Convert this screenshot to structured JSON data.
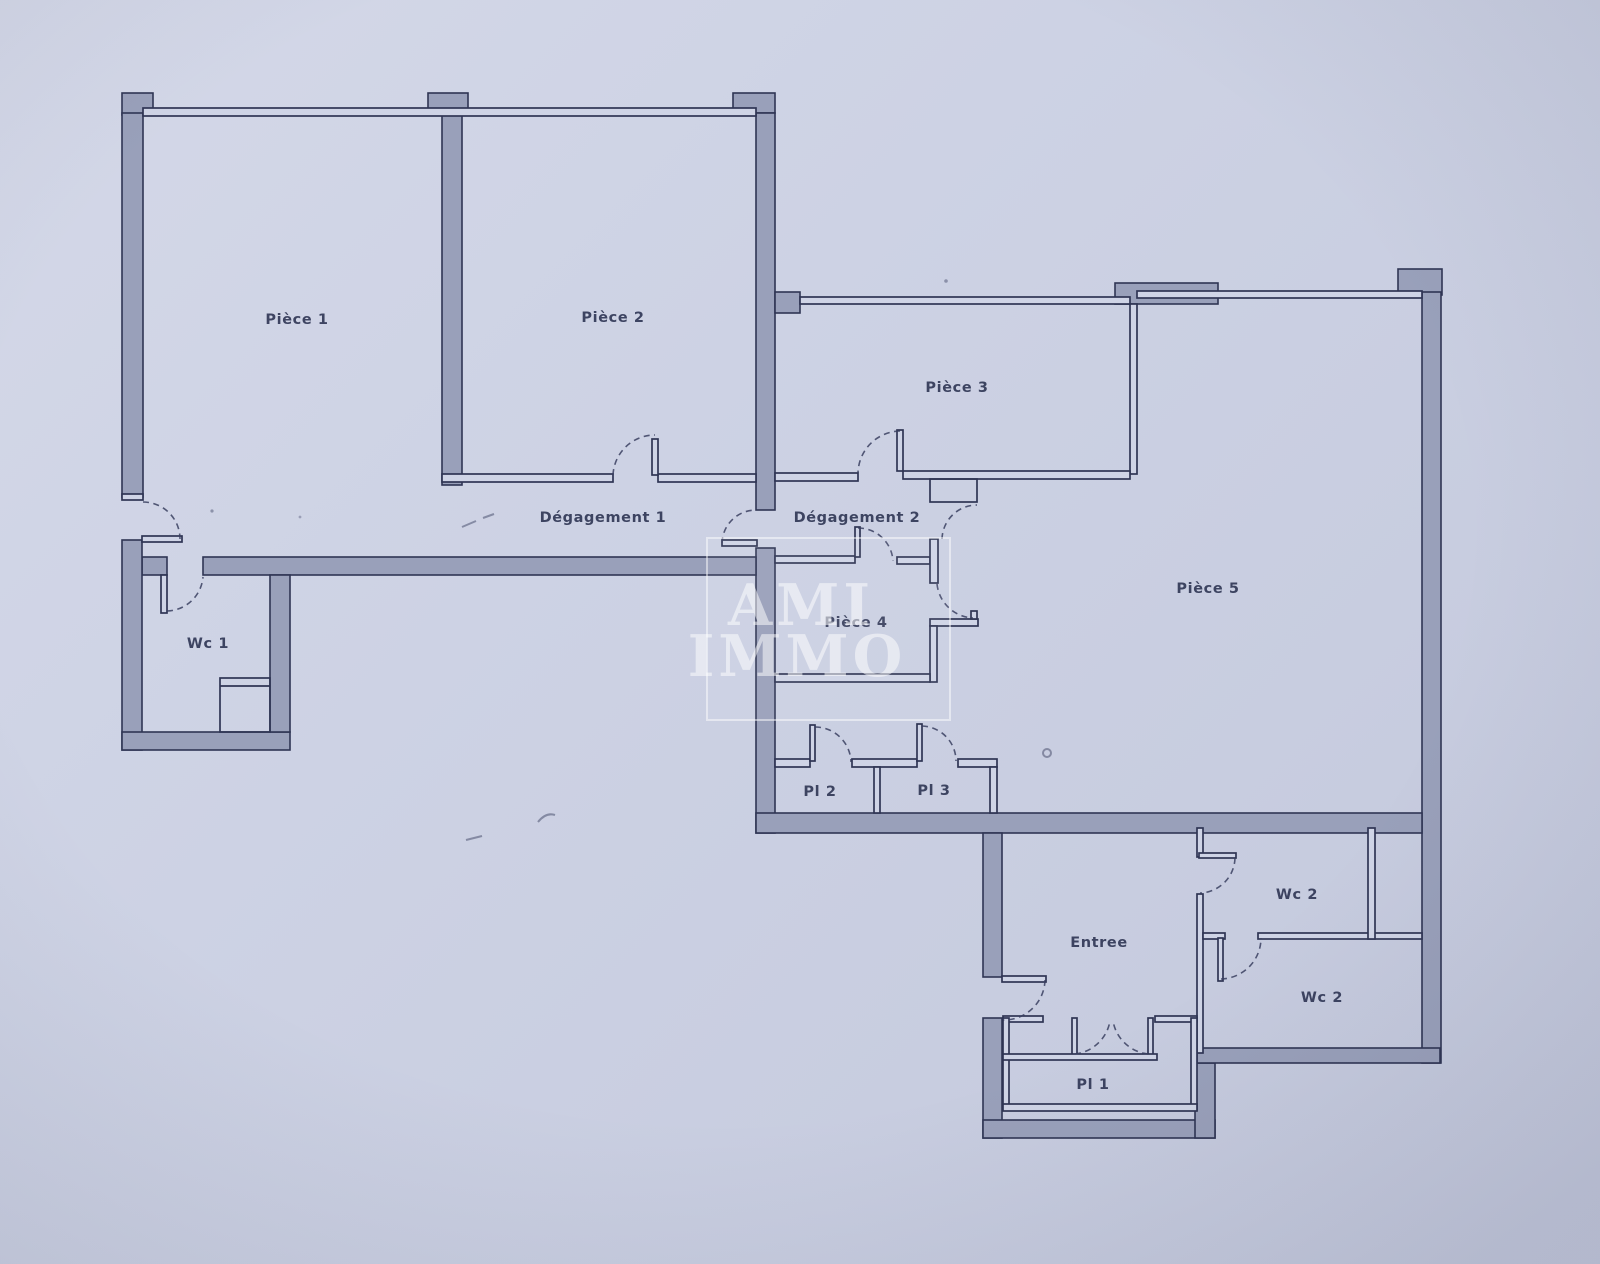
{
  "plan": {
    "rooms": [
      {
        "id": "piece-1",
        "label": "Pièce 1"
      },
      {
        "id": "piece-2",
        "label": "Pièce 2"
      },
      {
        "id": "piece-3",
        "label": "Pièce 3"
      },
      {
        "id": "piece-4",
        "label": "Pièce 4"
      },
      {
        "id": "piece-5",
        "label": "Pièce 5"
      },
      {
        "id": "degagement-1",
        "label": "Dégagement 1"
      },
      {
        "id": "degagement-2",
        "label": "Dégagement 2"
      },
      {
        "id": "wc-1",
        "label": "Wc 1"
      },
      {
        "id": "wc-2-upper",
        "label": "Wc 2"
      },
      {
        "id": "wc-2-lower",
        "label": "Wc 2"
      },
      {
        "id": "entree",
        "label": "Entree"
      },
      {
        "id": "pl-1",
        "label": "Pl 1"
      },
      {
        "id": "pl-2",
        "label": "Pl 2"
      },
      {
        "id": "pl-3",
        "label": "Pl 3"
      }
    ],
    "watermark": {
      "line1": "AMI",
      "line2": "IMMO"
    },
    "colors": {
      "paper": "#ccd1e3",
      "wall_fill": "#99a0ba",
      "line": "#2f3554",
      "label": "#2a3150",
      "watermark": "#ffffff"
    }
  }
}
